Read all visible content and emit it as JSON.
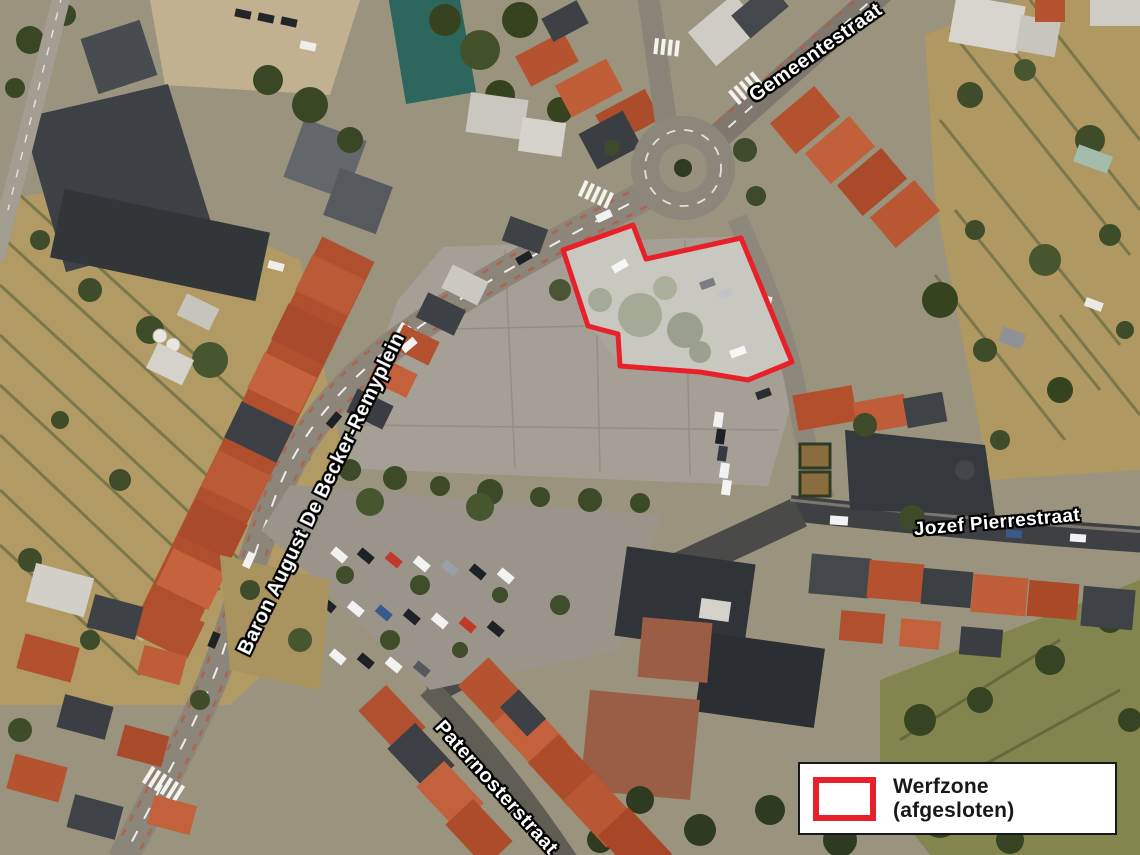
{
  "map": {
    "type": "satellite-aerial-view",
    "street_labels": [
      {
        "id": "gemeentestraat",
        "text": "Gemeentestraat"
      },
      {
        "id": "baron-august-de-becker-remyplein",
        "text": "Baron August De Becker-Remyplein"
      },
      {
        "id": "jozef-pierrestraat",
        "text": "Jozef Pierrestraat"
      },
      {
        "id": "paternosterstraat",
        "text": "Paternosterstraat"
      }
    ],
    "annotation": {
      "name": "werfzone",
      "outline_color": "#e8202a",
      "fill": "rgba(255,255,255,0.38)"
    },
    "legend": {
      "label": "Werfzone (afgesloten)",
      "swatch_color": "#e8202a"
    }
  }
}
